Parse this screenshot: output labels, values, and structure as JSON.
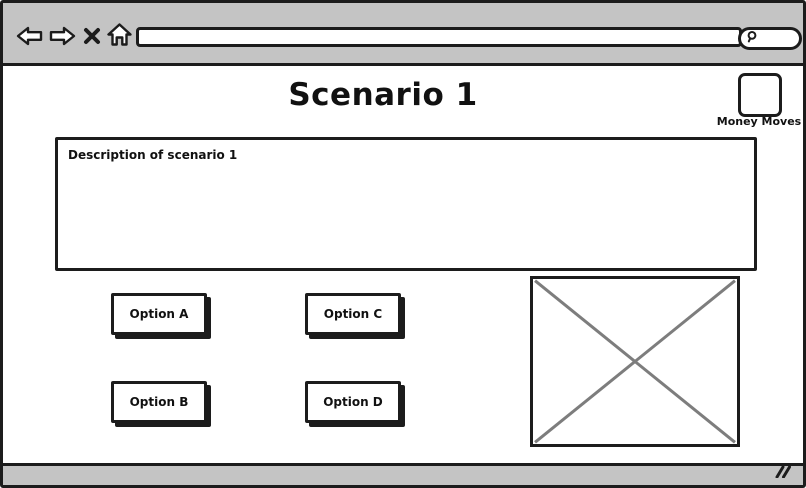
{
  "browser": {
    "toolbar": {
      "back_icon": "back-arrow",
      "forward_icon": "forward-arrow",
      "stop_icon": "x",
      "home_icon": "home",
      "url_value": "",
      "search_value": "",
      "search_icon": "magnifier"
    },
    "status_bar": {
      "resize_grip": "resize-grip"
    }
  },
  "page": {
    "title": "Scenario 1",
    "money_moves": {
      "label": "Money Moves",
      "checked": false
    },
    "description": {
      "value": "Description of scenario 1"
    },
    "options": [
      {
        "id": "option-a",
        "label": "Option A"
      },
      {
        "id": "option-b",
        "label": "Option B"
      },
      {
        "id": "option-c",
        "label": "Option C"
      },
      {
        "id": "option-d",
        "label": "Option D"
      }
    ],
    "image_placeholder": {
      "type": "image"
    }
  },
  "colors": {
    "chrome_gray": "#c4c4c4",
    "border_black": "#1c1c1c",
    "placeholder_x_gray": "#7d7d7d"
  }
}
